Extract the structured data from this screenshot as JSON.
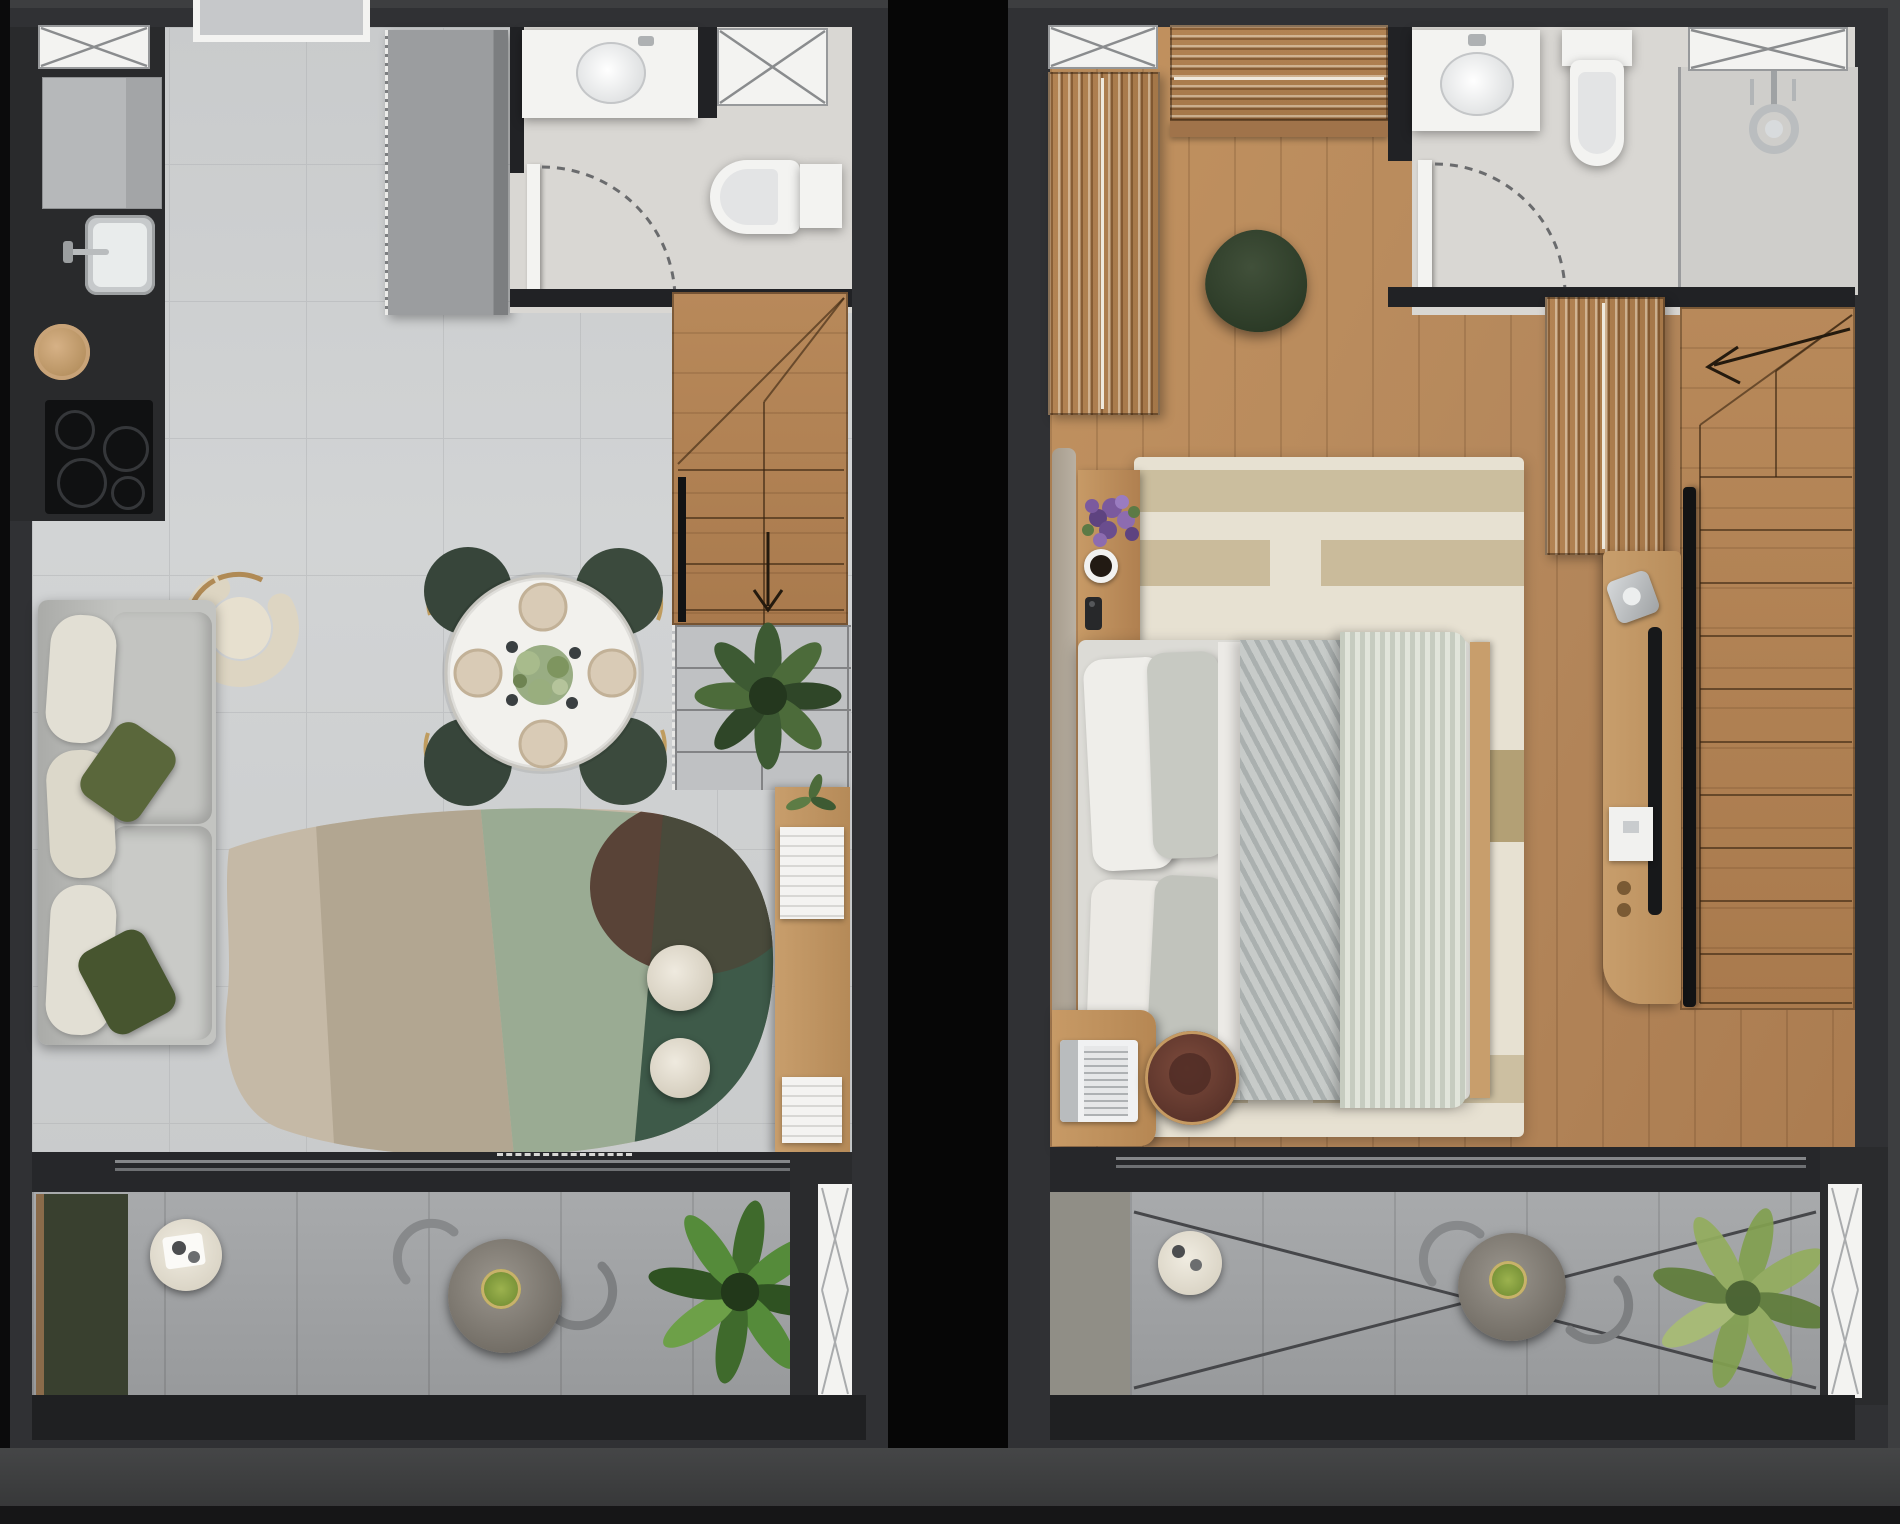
{
  "meta": {
    "title": "Apartment duplex floor plans — rendered top view",
    "description": "Two side-by-side photorealistic top-down floor plan renders: left is an open-plan living level with kitchen, dining, bathroom, stairs and balcony; right is a bedroom level with wardrobe, bathroom, bed, media console, stairs and balcony."
  },
  "colors": {
    "bg": "#3d3e40",
    "bg-bottom": "#454647",
    "bg-edge": "#161617",
    "gap": "#060606",
    "wall": "#303134",
    "wall-dark": "#212225",
    "tile": "#c9cbcc",
    "grout": "#b4b6b8",
    "bath-floor": "#d9d7d3",
    "shower-floor": "#cfcecb",
    "wood": "#b5885c",
    "wood-dark": "#a0734a",
    "wood-light": "#c89e6c",
    "white": "#f3f3f1",
    "green-dark": "#3e5a49",
    "sage": "#9aab93",
    "taupe": "#b2a691",
    "beige": "#c5b9a6",
    "maroon": "#543a2f",
    "olive": "#5a673b",
    "chair-green": "#37453a",
    "brass": "#bf9c5f",
    "sofa": "#c3c4c1",
    "cushion": "#e2dfd4",
    "balcony": "#a2a4a6",
    "greige": "#908e86",
    "planter": "#39402f",
    "plant": "#466332",
    "plant-light": "#82a050",
    "rug2": "#e7e1d2",
    "rug2-stripe": "#c6b795",
    "stool": "#6b4036",
    "dark": "#141517",
    "chrome": "#c9ccce",
    "purple": "#7b5a9e"
  },
  "left_plan": {
    "label": "Level 1 — open-plan living, kitchen and balcony",
    "items": {
      "kitchen_counter": "Kitchen counter run",
      "appliance": "Built-in appliance block",
      "sink": "Kitchen sink",
      "hat": "Round basket",
      "cooktop": "4-burner cooktop",
      "entry": "Entry niche",
      "window": "Window",
      "cabinet": "Tall storage cabinet",
      "bathroom": "Bathroom",
      "vanity": "Washbasin vanity",
      "toilet": "Toilet",
      "door": "Bathroom door swing",
      "stairs": "Winder staircase (down)",
      "railing": "Stair railing",
      "void_grid": "Glazed railing / void",
      "plant": "Potted plant",
      "console": "Wooden console with magazines",
      "dining": "Round dining table for four",
      "armchair": "Lounge armchair",
      "side_table": "Nesting side tables with tray",
      "sofa": "Sofa with olive cushions",
      "rug": "Organic-shaped area rug",
      "coffee_tables": "Round coffee tables",
      "balcony": "Balcony",
      "planter": "Balcony planter",
      "balcony_table": "Small balcony table",
      "bistro": "Outdoor bistro set",
      "balcony_plant": "Balcony plant",
      "glazing": "Glazing mullion"
    }
  },
  "right_plan": {
    "label": "Level 2 — bedroom, bathroom and balcony",
    "items": {
      "window": "Window",
      "wardrobe": "Open wardrobe with hanging clothes",
      "closet_top": "Hanging closet",
      "pouf": "Bean-bag pouf",
      "bathroom": "En-suite bathroom",
      "vanity": "Washbasin vanity",
      "toilet": "Toilet",
      "shower": "Walk-in shower",
      "door": "Bathroom door swing",
      "closet2": "Second hanging closet",
      "stairs": "Staircase (up)",
      "tv": "Wall-mounted TV",
      "console": "Media / coffee console",
      "nightstand": "Bedside table with flowers and coffee",
      "bed": "Double bed with quilt and duvet",
      "rug": "Striped bedroom rug",
      "desk": "Work desk with laptop",
      "stool": "Leather stool",
      "balcony": "Balcony with cross bracing",
      "balcony_table": "Small balcony table",
      "bistro": "Outdoor bistro set",
      "balcony_plant": "Balcony plant",
      "glazing": "Glazing mullion"
    }
  }
}
